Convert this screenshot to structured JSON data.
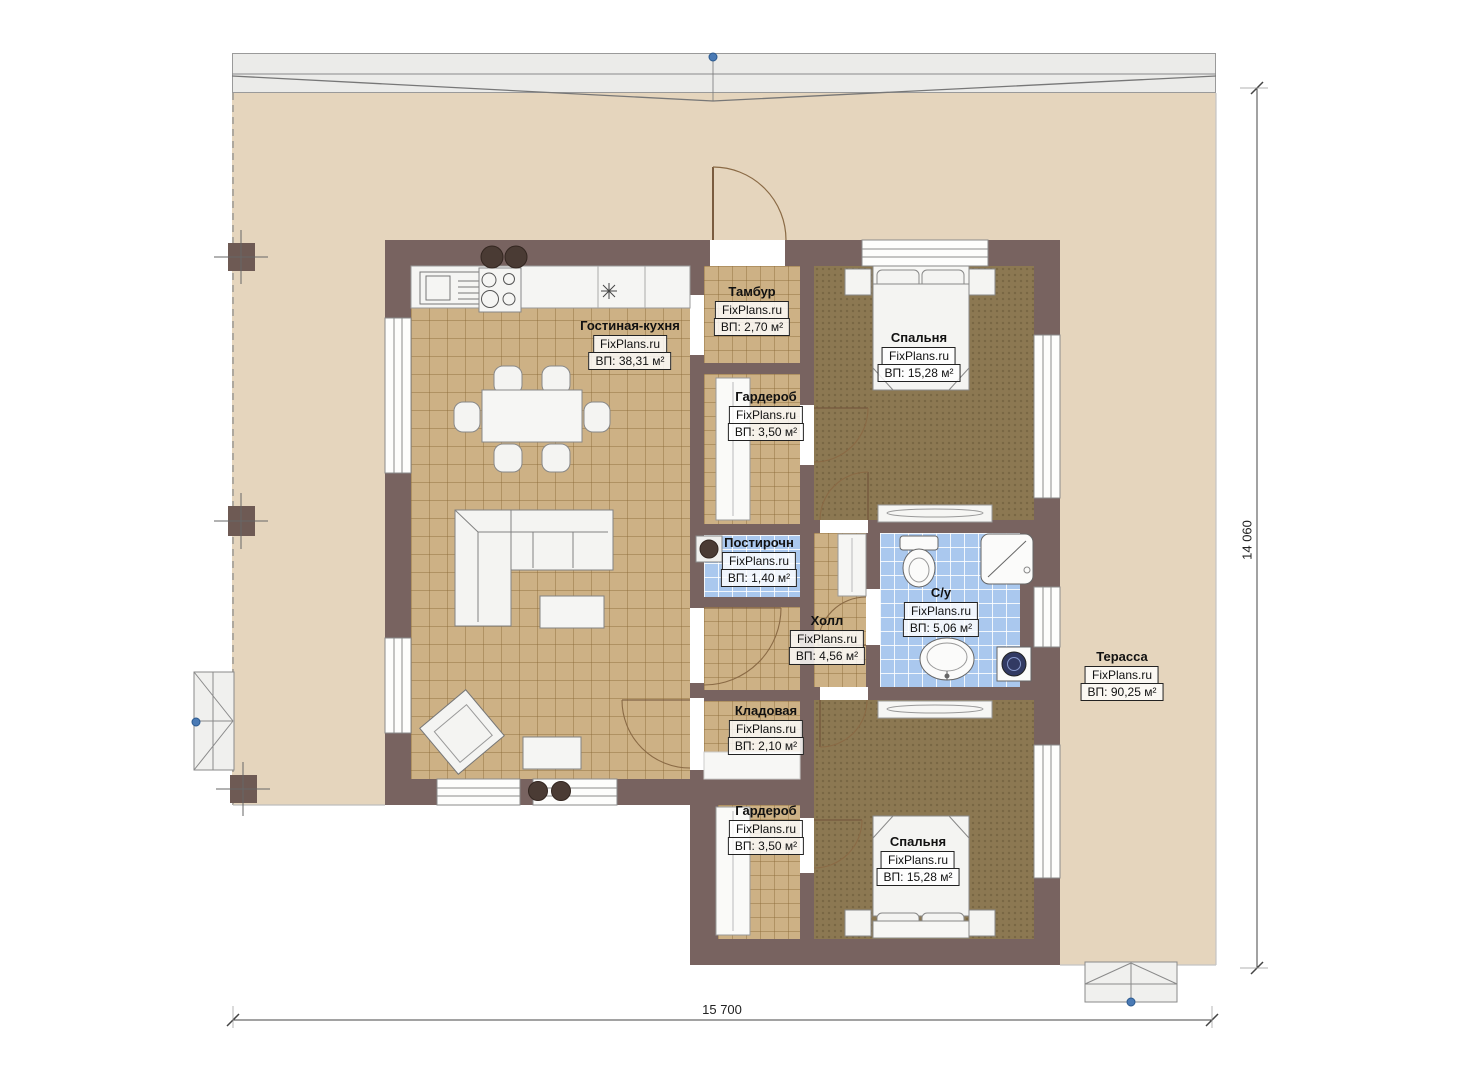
{
  "plan": {
    "brand": "FixPlans.ru",
    "rooms": [
      {
        "id": "living-kitchen",
        "name": "Гостиная-кухня",
        "brand": "FixPlans.ru",
        "area": "ВП: 38,31 м²"
      },
      {
        "id": "tambour",
        "name": "Тамбур",
        "brand": "FixPlans.ru",
        "area": "ВП: 2,70 м²"
      },
      {
        "id": "wardrobe-1",
        "name": "Гардероб",
        "brand": "FixPlans.ru",
        "area": "ВП: 3,50 м²"
      },
      {
        "id": "bedroom-1",
        "name": "Спальня",
        "brand": "FixPlans.ru",
        "area": "ВП: 15,28 м²"
      },
      {
        "id": "laundry",
        "name": "Постирочн",
        "brand": "FixPlans.ru",
        "area": "ВП: 1,40 м²"
      },
      {
        "id": "hall",
        "name": "Холл",
        "brand": "FixPlans.ru",
        "area": "ВП: 4,56 м²"
      },
      {
        "id": "bathroom",
        "name": "С/у",
        "brand": "FixPlans.ru",
        "area": "ВП: 5,06 м²"
      },
      {
        "id": "storage",
        "name": "Кладовая",
        "brand": "FixPlans.ru",
        "area": "ВП: 2,10 м²"
      },
      {
        "id": "wardrobe-2",
        "name": "Гардероб",
        "brand": "FixPlans.ru",
        "area": "ВП: 3,50 м²"
      },
      {
        "id": "bedroom-2",
        "name": "Спальня",
        "brand": "FixPlans.ru",
        "area": "ВП: 15,28 м²"
      },
      {
        "id": "terrace",
        "name": "Терасса",
        "brand": "FixPlans.ru",
        "area": "ВП: 90,25 м²"
      }
    ],
    "dimensions": {
      "width": "15 700",
      "height": "14 060"
    },
    "colors": {
      "wall": "#786360",
      "terrace": "#e5d5bd",
      "tile": "#cdb185",
      "bedfloor": "#8c7852",
      "wetfloor": "#aac8ee",
      "marker": "#4a7ab5"
    }
  }
}
